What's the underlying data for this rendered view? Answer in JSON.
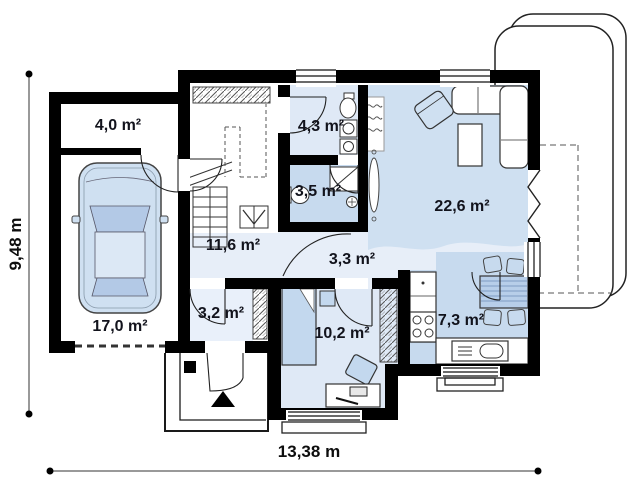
{
  "plan": {
    "type": "house-floor-plan",
    "rooms": {
      "storage": {
        "area": "4,0 m²"
      },
      "garage": {
        "area": "17,0 m²"
      },
      "hall": {
        "area": "11,6 m²"
      },
      "bathroom": {
        "area": "4,3 m²"
      },
      "wc": {
        "area": "3,5 m²"
      },
      "living": {
        "area": "22,6 m²"
      },
      "corridor": {
        "area": "3,3 m²"
      },
      "entry": {
        "area": "3,2 m²"
      },
      "bedroom": {
        "area": "10,2 m²"
      },
      "kitchen": {
        "area": "7,3 m²"
      }
    },
    "dimensions": {
      "width": "13,38 m",
      "height": "9,48 m"
    },
    "colors": {
      "wall": "#000000",
      "room_light_blue": "#cfe0f1",
      "room_medium_blue": "#c7daee",
      "room_pale_blue": "#e7eef8",
      "room_soft_blue": "#dfe9f6",
      "furniture_blue": "#c3d8ee"
    }
  }
}
